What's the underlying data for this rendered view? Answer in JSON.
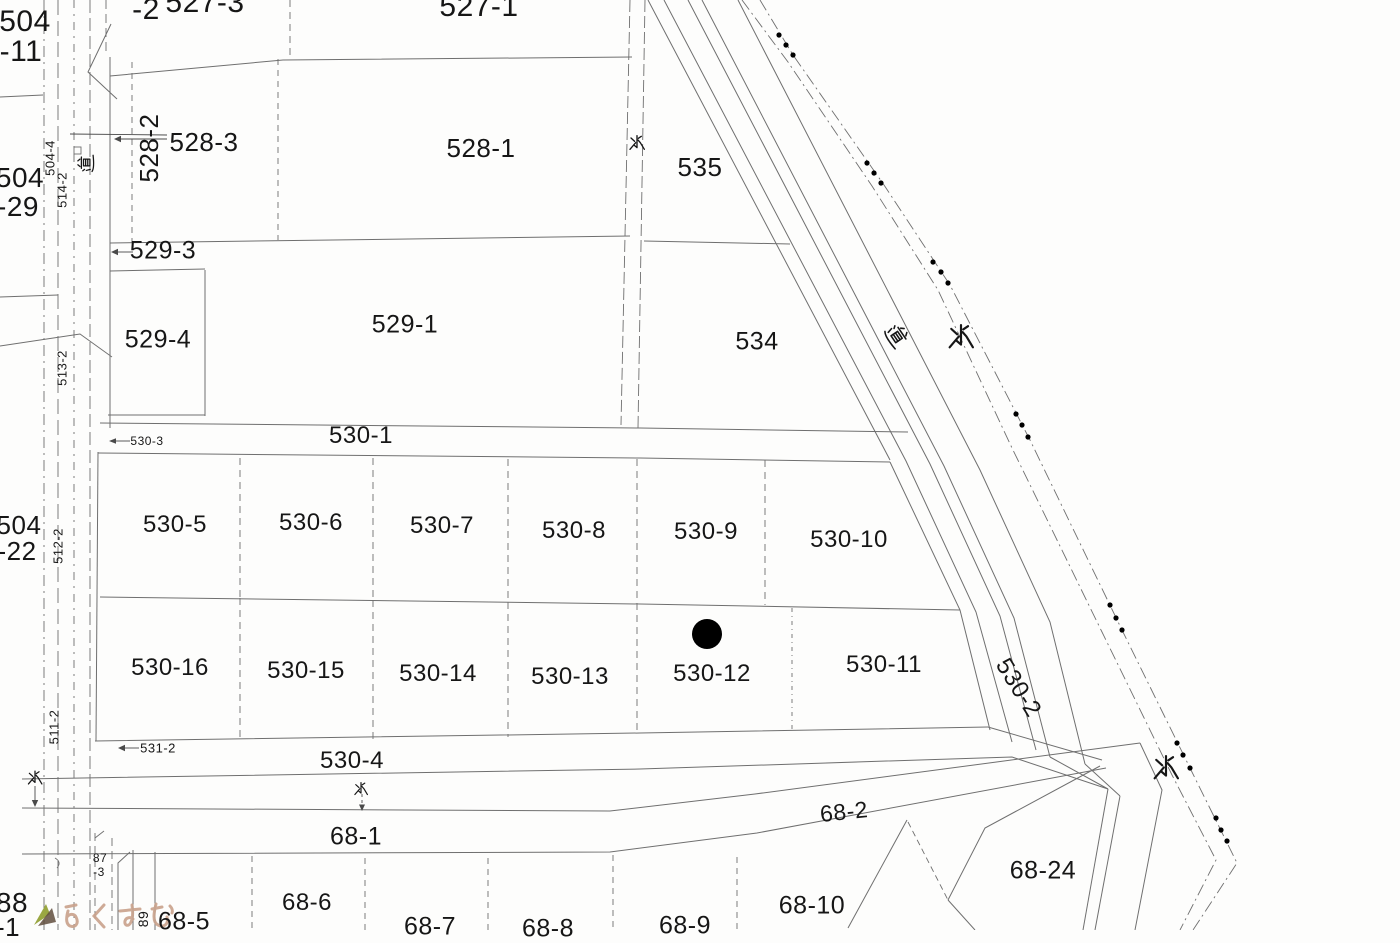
{
  "document": {
    "kind": "cadastral-map-scan",
    "description": "Japanese land-registry (kozu) parcel map scan with road and waterway corridors"
  },
  "colors": {
    "paper": "#fdfdfc",
    "line": "#6f6f6f",
    "line_dark": "#4a4a4a",
    "text": "#161616",
    "marker": "#000000",
    "watermark_text": "#c9a28c",
    "watermark_leaf": "#9aa742",
    "watermark_dark": "#604e3d"
  },
  "legend": {
    "water_label": "水",
    "road_label": "道",
    "watermark": "らくすむ"
  },
  "map": {
    "parcel_labels": [
      {
        "t": "504",
        "x": 25,
        "y": 22,
        "s": 30
      },
      {
        "t": "-11",
        "x": 21,
        "y": 52,
        "s": 30
      },
      {
        "t": "-2",
        "x": 146,
        "y": 10,
        "s": 30
      },
      {
        "t": "527-3",
        "x": 205,
        "y": 3,
        "s": 30
      },
      {
        "t": "527-1",
        "x": 479,
        "y": 7,
        "s": 30
      },
      {
        "t": "504",
        "x": 20,
        "y": 178,
        "s": 28
      },
      {
        "t": "-29",
        "x": 18,
        "y": 207,
        "s": 28
      },
      {
        "t": "504-4",
        "x": 50,
        "y": 158,
        "s": 13,
        "r": -90
      },
      {
        "t": "514-2",
        "x": 62,
        "y": 190,
        "s": 13,
        "r": -90
      },
      {
        "t": "528-2",
        "x": 149,
        "y": 148,
        "s": 26,
        "r": -90
      },
      {
        "t": "528-3",
        "x": 204,
        "y": 142,
        "s": 26
      },
      {
        "t": "528-1",
        "x": 481,
        "y": 148,
        "s": 26
      },
      {
        "t": "535",
        "x": 700,
        "y": 167,
        "s": 26
      },
      {
        "t": "529-3",
        "x": 163,
        "y": 251,
        "s": 25
      },
      {
        "t": "529-4",
        "x": 158,
        "y": 340,
        "s": 25
      },
      {
        "t": "529-1",
        "x": 405,
        "y": 325,
        "s": 25
      },
      {
        "t": "513-2",
        "x": 62,
        "y": 368,
        "s": 13,
        "r": -90
      },
      {
        "t": "534",
        "x": 757,
        "y": 342,
        "s": 25
      },
      {
        "t": "530-1",
        "x": 361,
        "y": 436,
        "s": 24
      },
      {
        "t": "530-3",
        "x": 147,
        "y": 441,
        "s": 12
      },
      {
        "t": "504",
        "x": 19,
        "y": 525,
        "s": 26
      },
      {
        "t": "-22",
        "x": 17,
        "y": 551,
        "s": 26
      },
      {
        "t": "512-2",
        "x": 58,
        "y": 546,
        "s": 13,
        "r": -90
      },
      {
        "t": "530-5",
        "x": 175,
        "y": 525,
        "s": 24
      },
      {
        "t": "530-6",
        "x": 311,
        "y": 523,
        "s": 24
      },
      {
        "t": "530-7",
        "x": 442,
        "y": 526,
        "s": 24
      },
      {
        "t": "530-8",
        "x": 574,
        "y": 531,
        "s": 24
      },
      {
        "t": "530-9",
        "x": 706,
        "y": 532,
        "s": 24
      },
      {
        "t": "530-10",
        "x": 849,
        "y": 540,
        "s": 24
      },
      {
        "t": "530-16",
        "x": 170,
        "y": 668,
        "s": 24
      },
      {
        "t": "530-15",
        "x": 306,
        "y": 671,
        "s": 24
      },
      {
        "t": "530-14",
        "x": 438,
        "y": 674,
        "s": 24
      },
      {
        "t": "530-13",
        "x": 570,
        "y": 677,
        "s": 24
      },
      {
        "t": "530-12",
        "x": 712,
        "y": 674,
        "s": 24
      },
      {
        "t": "530-11",
        "x": 884,
        "y": 665,
        "s": 24
      },
      {
        "t": "511-2",
        "x": 54,
        "y": 727,
        "s": 13,
        "r": -90
      },
      {
        "t": "531-2",
        "x": 158,
        "y": 748,
        "s": 13
      },
      {
        "t": "530-4",
        "x": 352,
        "y": 761,
        "s": 24
      },
      {
        "t": "68-1",
        "x": 356,
        "y": 837,
        "s": 25
      },
      {
        "t": "68-2",
        "x": 844,
        "y": 812,
        "s": 23,
        "r": -6
      },
      {
        "t": "87",
        "x": 100,
        "y": 858,
        "s": 12
      },
      {
        "t": "-3",
        "x": 99,
        "y": 872,
        "s": 12
      },
      {
        "t": "88",
        "x": 12,
        "y": 903,
        "s": 28
      },
      {
        "t": "-1",
        "x": 8,
        "y": 927,
        "s": 26
      },
      {
        "t": "89",
        "x": 143,
        "y": 919,
        "s": 14,
        "r": -90
      },
      {
        "t": "68-5",
        "x": 184,
        "y": 922,
        "s": 25
      },
      {
        "t": "68-6",
        "x": 307,
        "y": 903,
        "s": 24
      },
      {
        "t": "68-7",
        "x": 430,
        "y": 927,
        "s": 25
      },
      {
        "t": "68-8",
        "x": 548,
        "y": 929,
        "s": 25
      },
      {
        "t": "68-9",
        "x": 685,
        "y": 926,
        "s": 25
      },
      {
        "t": "68-10",
        "x": 812,
        "y": 906,
        "s": 25
      },
      {
        "t": "68-24",
        "x": 1043,
        "y": 871,
        "s": 25
      },
      {
        "t": "530-2",
        "x": 1018,
        "y": 688,
        "s": 24,
        "r": 58
      }
    ],
    "cjk_labels": [
      {
        "t": "水",
        "x": 637,
        "y": 143,
        "s": 16
      },
      {
        "t": "水",
        "x": 961,
        "y": 337,
        "s": 26
      },
      {
        "t": "水",
        "x": 361,
        "y": 789,
        "s": 14
      },
      {
        "t": "水",
        "x": 35,
        "y": 778,
        "s": 15
      },
      {
        "t": "水",
        "x": 1166,
        "y": 768,
        "s": 26
      },
      {
        "t": "道",
        "x": 86,
        "y": 163,
        "s": 17,
        "r": -90
      },
      {
        "t": "道",
        "x": 897,
        "y": 336,
        "s": 21,
        "r": 56
      }
    ],
    "selected_parcel_marker": {
      "x": 707,
      "y": 634,
      "r": 15
    },
    "boundary_dots": [
      [
        779,
        35
      ],
      [
        786,
        45
      ],
      [
        793,
        55
      ],
      [
        867,
        163
      ],
      [
        874,
        173
      ],
      [
        881,
        183
      ],
      [
        933,
        262
      ],
      [
        941,
        272
      ],
      [
        948,
        283
      ],
      [
        1016,
        414
      ],
      [
        1022,
        425
      ],
      [
        1028,
        437
      ],
      [
        1110,
        605
      ],
      [
        1116,
        618
      ],
      [
        1122,
        630
      ],
      [
        1177,
        743
      ],
      [
        1183,
        755
      ],
      [
        1190,
        768
      ],
      [
        1216,
        818
      ],
      [
        1221,
        830
      ],
      [
        1227,
        841
      ]
    ]
  }
}
